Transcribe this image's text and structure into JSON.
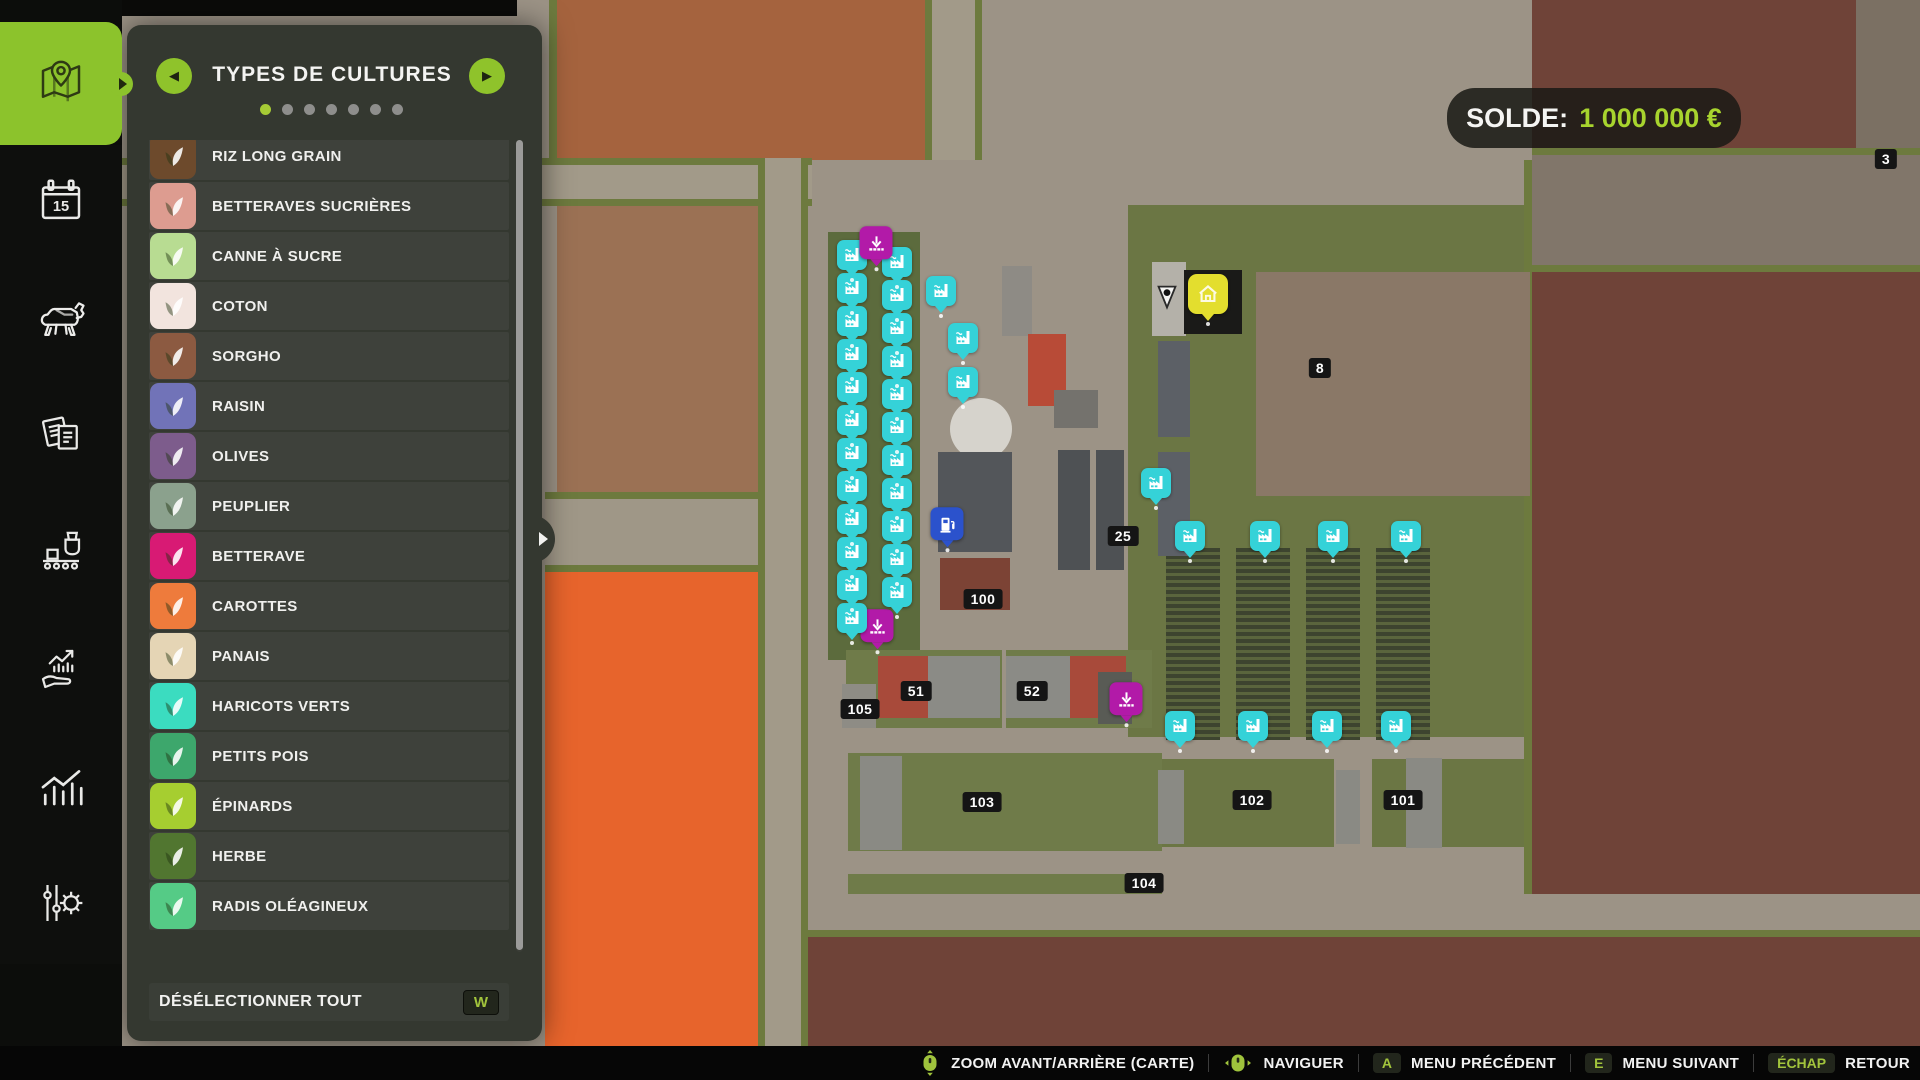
{
  "accent_color": "#8cc32c",
  "hud": {
    "balance_label": "SOLDE:",
    "balance_value": "1 000 000 €"
  },
  "panel": {
    "title": "TYPES DE CULTURES",
    "pager": {
      "dot_count": 7,
      "active_index": 0
    },
    "items": [
      {
        "label": "RIZ LONG GRAIN",
        "icon": "rice",
        "color": "#6d4a2c"
      },
      {
        "label": "BETTERAVES SUCRIÈRES",
        "icon": "sugar-beet",
        "color": "#dd9c90"
      },
      {
        "label": "CANNE À SUCRE",
        "icon": "sugarcane",
        "color": "#b8dc92"
      },
      {
        "label": "COTON",
        "icon": "cotton",
        "color": "#f2e4de"
      },
      {
        "label": "SORGHO",
        "icon": "sorghum",
        "color": "#8c5a41"
      },
      {
        "label": "RAISIN",
        "icon": "grape",
        "color": "#7173b8"
      },
      {
        "label": "OLIVES",
        "icon": "olive",
        "color": "#7d5c8c"
      },
      {
        "label": "PEUPLIER",
        "icon": "poplar",
        "color": "#8ba18d"
      },
      {
        "label": "BETTERAVE",
        "icon": "beetroot",
        "color": "#d81a74"
      },
      {
        "label": "CAROTTES",
        "icon": "carrot",
        "color": "#ee7b3c"
      },
      {
        "label": "PANAIS",
        "icon": "parsnip",
        "color": "#e5d5b5"
      },
      {
        "label": "HARICOTS VERTS",
        "icon": "green-beans",
        "color": "#3bdcc0"
      },
      {
        "label": "PETITS POIS",
        "icon": "peas",
        "color": "#3da76c"
      },
      {
        "label": "ÉPINARDS",
        "icon": "spinach",
        "color": "#a6ce30"
      },
      {
        "label": "HERBE",
        "icon": "grass",
        "color": "#517630"
      },
      {
        "label": "RADIS OLÉAGINEUX",
        "icon": "oilseed-radish",
        "color": "#55cb86"
      }
    ],
    "footer": {
      "label": "DÉSÉLECTIONNER TOUT",
      "key": "W"
    }
  },
  "sidebar": {
    "calendar_day": "15",
    "tabs": [
      {
        "name": "map",
        "active": true
      },
      {
        "name": "calendar",
        "active": false
      },
      {
        "name": "animals",
        "active": false
      },
      {
        "name": "contracts",
        "active": false
      },
      {
        "name": "production",
        "active": false
      },
      {
        "name": "finances",
        "active": false
      },
      {
        "name": "statistics",
        "active": false
      },
      {
        "name": "settings",
        "active": false
      }
    ]
  },
  "map": {
    "marker_colors": {
      "production": "#35d2d8",
      "unload": "#b21aa8",
      "fuel": "#2b52cc",
      "home": "#e3de2e"
    },
    "field_badges": [
      {
        "label": "3",
        "x": 1886,
        "y": 159
      },
      {
        "label": "8",
        "x": 1320,
        "y": 368
      },
      {
        "label": "25",
        "x": 1123,
        "y": 536
      },
      {
        "label": "100",
        "x": 983,
        "y": 599
      },
      {
        "label": "51",
        "x": 916,
        "y": 691
      },
      {
        "label": "52",
        "x": 1032,
        "y": 691
      },
      {
        "label": "105",
        "x": 860,
        "y": 709
      },
      {
        "label": "103",
        "x": 982,
        "y": 802
      },
      {
        "label": "102",
        "x": 1252,
        "y": 800
      },
      {
        "label": "101",
        "x": 1403,
        "y": 800
      },
      {
        "label": "104",
        "x": 1144,
        "y": 883
      }
    ],
    "markers": [
      {
        "type": "production",
        "x": 852,
        "y": 258
      },
      {
        "type": "production",
        "x": 852,
        "y": 291
      },
      {
        "type": "production",
        "x": 852,
        "y": 324
      },
      {
        "type": "production",
        "x": 852,
        "y": 357
      },
      {
        "type": "production",
        "x": 852,
        "y": 390
      },
      {
        "type": "production",
        "x": 852,
        "y": 423
      },
      {
        "type": "production",
        "x": 852,
        "y": 456
      },
      {
        "type": "production",
        "x": 852,
        "y": 489
      },
      {
        "type": "production",
        "x": 852,
        "y": 522
      },
      {
        "type": "production",
        "x": 852,
        "y": 555
      },
      {
        "type": "production",
        "x": 852,
        "y": 588
      },
      {
        "type": "production",
        "x": 852,
        "y": 621
      },
      {
        "type": "production",
        "x": 897,
        "y": 265
      },
      {
        "type": "production",
        "x": 897,
        "y": 298
      },
      {
        "type": "production",
        "x": 897,
        "y": 331
      },
      {
        "type": "production",
        "x": 897,
        "y": 364
      },
      {
        "type": "production",
        "x": 897,
        "y": 397
      },
      {
        "type": "production",
        "x": 897,
        "y": 430
      },
      {
        "type": "production",
        "x": 897,
        "y": 463
      },
      {
        "type": "production",
        "x": 897,
        "y": 496
      },
      {
        "type": "production",
        "x": 897,
        "y": 529
      },
      {
        "type": "production",
        "x": 897,
        "y": 562
      },
      {
        "type": "production",
        "x": 897,
        "y": 595
      },
      {
        "type": "production",
        "x": 941,
        "y": 294
      },
      {
        "type": "production",
        "x": 963,
        "y": 341
      },
      {
        "type": "production",
        "x": 963,
        "y": 385
      },
      {
        "type": "production",
        "x": 1156,
        "y": 486
      },
      {
        "type": "production",
        "x": 1190,
        "y": 539
      },
      {
        "type": "production",
        "x": 1265,
        "y": 539
      },
      {
        "type": "production",
        "x": 1333,
        "y": 539
      },
      {
        "type": "production",
        "x": 1406,
        "y": 539
      },
      {
        "type": "production",
        "x": 1180,
        "y": 729
      },
      {
        "type": "production",
        "x": 1253,
        "y": 729
      },
      {
        "type": "production",
        "x": 1327,
        "y": 729
      },
      {
        "type": "production",
        "x": 1396,
        "y": 729
      },
      {
        "type": "unload",
        "x": 876,
        "y": 246
      },
      {
        "type": "unload",
        "x": 877,
        "y": 629
      },
      {
        "type": "unload",
        "x": 1126,
        "y": 702
      },
      {
        "type": "fuel",
        "x": 947,
        "y": 527
      },
      {
        "type": "home",
        "x": 1208,
        "y": 298
      },
      {
        "type": "player",
        "x": 1167,
        "y": 300
      }
    ]
  },
  "bottom_bar": {
    "items": [
      {
        "icon": "mouse-zoom",
        "label": "ZOOM AVANT/ARRIÈRE (CARTE)"
      },
      {
        "icon": "mouse-nav",
        "label": "NAVIGUER"
      },
      {
        "key": "A",
        "label": "MENU PRÉCÉDENT"
      },
      {
        "key": "E",
        "label": "MENU SUIVANT"
      },
      {
        "key": "ÉCHAP",
        "label": "RETOUR"
      }
    ]
  }
}
